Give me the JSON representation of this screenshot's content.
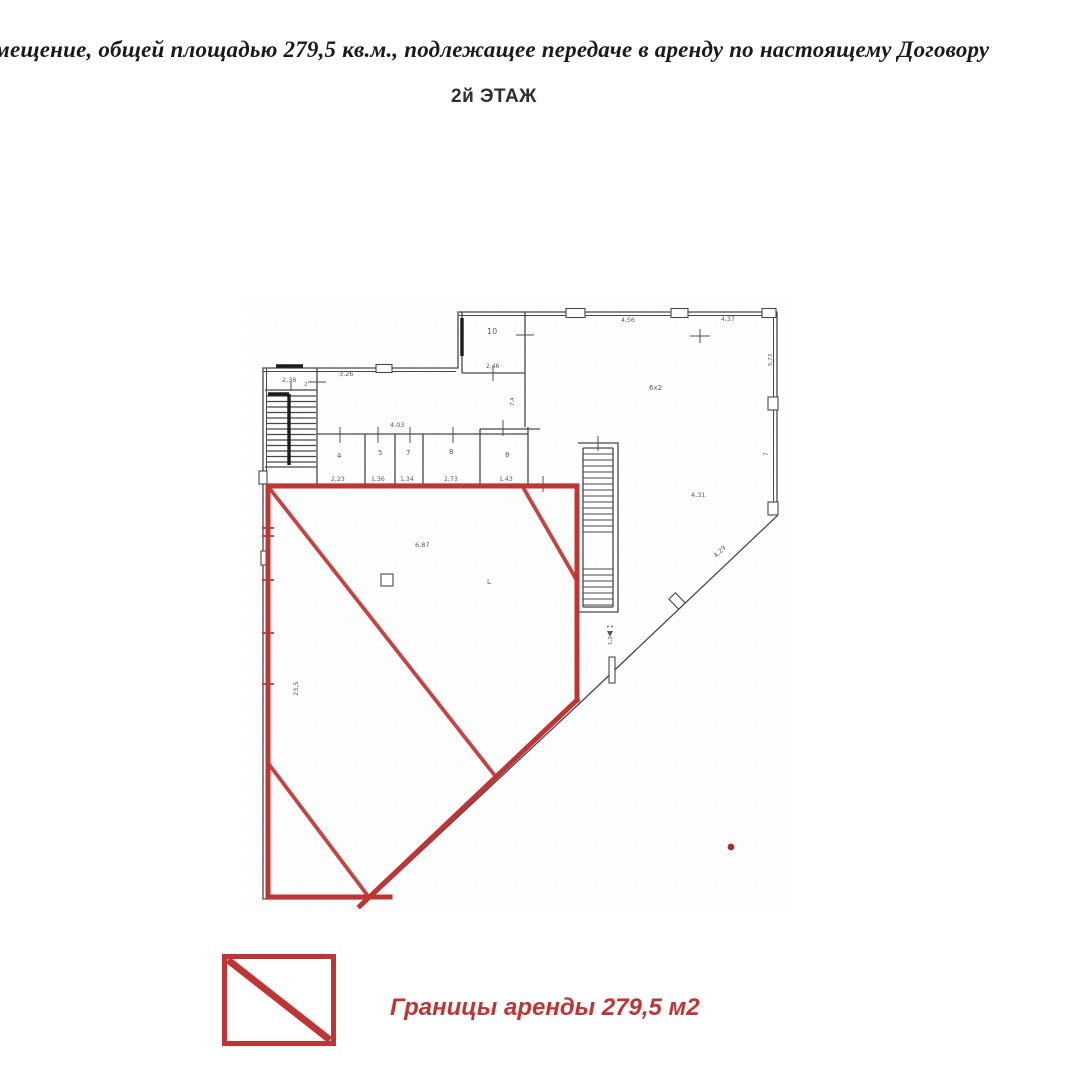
{
  "document": {
    "header_line": "мещение, общей площадью 279,5 кв.м., подлежащее передаче в аренду по настоящему Договору",
    "floor_title": "2й ЭТАЖ"
  },
  "legend": {
    "swatch_icon": "red-square-with-diagonal",
    "label": "Границы аренды 279,5 м2"
  },
  "plan": {
    "colors": {
      "wall": "#474747",
      "wall_dark": "#1c1c1c",
      "lease": "#bf3535",
      "lease_dark": "#a93030",
      "label": "#5a5a5a",
      "text": "#1a1a1a"
    },
    "labels": [
      {
        "text": "2,36",
        "x": 282,
        "y": 382,
        "size": 6.5
      },
      {
        "text": "2",
        "x": 304,
        "y": 386,
        "size": 5.5
      },
      {
        "text": "3,26",
        "x": 339,
        "y": 376,
        "size": 6.5
      },
      {
        "text": "10",
        "x": 487,
        "y": 334,
        "size": 8
      },
      {
        "text": "2,46",
        "x": 486,
        "y": 368,
        "size": 6
      },
      {
        "text": "4,03",
        "x": 390,
        "y": 427,
        "size": 6.5
      },
      {
        "text": "7,4",
        "x": 514,
        "y": 406,
        "size": 5.5,
        "rot": -90
      },
      {
        "text": "4",
        "x": 337,
        "y": 458,
        "size": 7
      },
      {
        "text": "5",
        "x": 378,
        "y": 455,
        "size": 7
      },
      {
        "text": "7",
        "x": 406,
        "y": 455,
        "size": 7
      },
      {
        "text": "8",
        "x": 449,
        "y": 454,
        "size": 7
      },
      {
        "text": "8",
        "x": 505,
        "y": 457,
        "size": 7
      },
      {
        "text": "2,23",
        "x": 331,
        "y": 481,
        "size": 6.2
      },
      {
        "text": "1,36",
        "x": 371,
        "y": 481,
        "size": 6.2
      },
      {
        "text": "1,34",
        "x": 400,
        "y": 481,
        "size": 6.2
      },
      {
        "text": "2,73",
        "x": 444,
        "y": 481,
        "size": 6.2
      },
      {
        "text": "1,43",
        "x": 499,
        "y": 481,
        "size": 6.2
      },
      {
        "text": "4,56",
        "x": 621,
        "y": 322,
        "size": 6.2
      },
      {
        "text": "4,37",
        "x": 721,
        "y": 321,
        "size": 6.2
      },
      {
        "text": "6х2",
        "x": 649,
        "y": 390,
        "size": 7
      },
      {
        "text": "4,31",
        "x": 691,
        "y": 497,
        "size": 6.5
      },
      {
        "text": "4,29",
        "x": 716,
        "y": 558,
        "size": 6.5,
        "rot": -44
      },
      {
        "text": "5,73",
        "x": 772,
        "y": 366,
        "size": 5.5,
        "rot": -90
      },
      {
        "text": "7",
        "x": 768,
        "y": 456,
        "size": 6,
        "rot": -90
      },
      {
        "text": "23,5",
        "x": 298,
        "y": 696,
        "size": 6.5,
        "rot": -90
      },
      {
        "text": "1,2",
        "x": 612,
        "y": 645,
        "size": 5.5,
        "rot": -90
      },
      {
        "text": "6,87",
        "x": 415,
        "y": 547,
        "size": 6.5
      },
      {
        "text": "L",
        "x": 487,
        "y": 584,
        "size": 7
      }
    ]
  }
}
